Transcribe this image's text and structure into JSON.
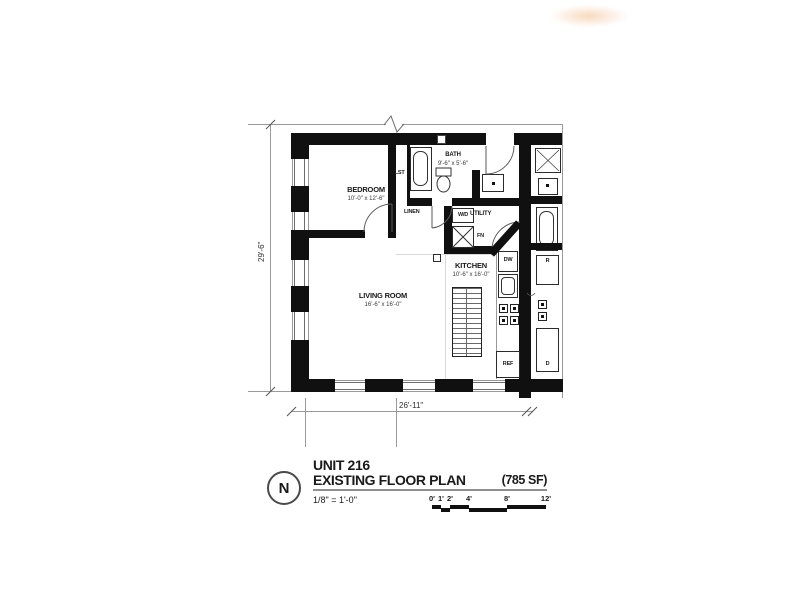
{
  "rooms": {
    "bedroom": {
      "name": "BEDROOM",
      "dims": "10'-0\" x 12'-6\""
    },
    "closet": {
      "name": "CLST"
    },
    "bath": {
      "name": "BATH",
      "dims": "9'-6\" x 5'-6\""
    },
    "linen": {
      "name": "LINEN"
    },
    "utility": {
      "name": "UTILITY"
    },
    "kitchen": {
      "name": "KITCHEN",
      "dims": "10'-6\" x 16'-0\""
    },
    "living_room": {
      "name": "LIVING ROOM",
      "dims": "16'-6\" x 16'-0\""
    }
  },
  "fixtures": {
    "washer_dryer": "W/D",
    "furnace": "FN",
    "dishwasher": "DW",
    "refrigerator": "REF",
    "neighbor_refrigerator": "R",
    "neighbor_dishwasher": "D"
  },
  "dimensions": {
    "overall_width": "26'-11\"",
    "overall_height": "29'-6\""
  },
  "title_block": {
    "unit_label": "UNIT 216",
    "plan_label": "EXISTING FLOOR PLAN",
    "area_label": "(785 SF)",
    "scale_label": "1/8\" = 1'-0\"",
    "north_label": "N",
    "scale_bar_labels": [
      "0'",
      "1'",
      "2'",
      "4'",
      "8'",
      "12'"
    ]
  },
  "colors": {
    "wall": "#101010",
    "thin_line": "#9a9a9a",
    "watermark": "#f1ba89"
  }
}
